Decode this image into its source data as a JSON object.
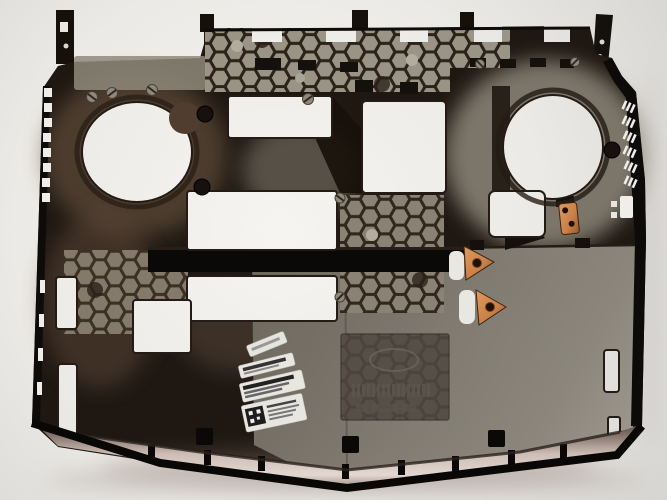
{
  "meta": {
    "type": "photograph",
    "subject": "laptop bottom base cover, inside view, photographed top-down on a light surface",
    "alt": "Dark bronze-black plastic laptop bottom chassis with two round fan openings, honeycomb vent grids, rectangular bay cutouts, copper clips and white service stickers"
  },
  "colors": {
    "background": "#e9e7e3",
    "chassis_dark": "#1d1610",
    "bronze_tint": "#6b5443",
    "plate_gray": "#7d7870",
    "honeycomb_cell": "#9a9487",
    "honeycomb_wall": "#2c221a",
    "copper": "#c97f45",
    "cutout_white": "#f2f0ec",
    "reflective_strip": "#cfc0b8",
    "sticker_white": "#e8e6e1"
  },
  "parts": {
    "chassis": {
      "name": "laptop-bottom-case"
    },
    "fan_openings": [
      {
        "name": "left-fan-opening"
      },
      {
        "name": "right-fan-opening"
      }
    ],
    "honeycomb_patches": [
      {
        "name": "top-vent-honeycomb"
      },
      {
        "name": "mid-left-honeycomb"
      },
      {
        "name": "mid-right-honeycomb"
      }
    ],
    "bay_openings": [
      {
        "name": "upper-left-bay-opening"
      },
      {
        "name": "upper-right-bay-opening"
      },
      {
        "name": "center-bay-opening"
      },
      {
        "name": "lower-center-bay-opening"
      },
      {
        "name": "lower-left-bay-opening"
      },
      {
        "name": "below-right-fan-opening"
      }
    ],
    "copper_clips": [
      {
        "name": "copper-clip-upper",
        "has_screw": true
      },
      {
        "name": "copper-clip-lower",
        "has_screw": true
      },
      {
        "name": "copper-bracket",
        "holes": 2
      }
    ],
    "stickers": [
      {
        "name": "small-service-sticker",
        "legible": false
      },
      {
        "name": "part-number-sticker",
        "legible": false
      },
      {
        "name": "serial-number-sticker",
        "legible": false
      },
      {
        "name": "qr-code-sticker",
        "legible": false,
        "has_qr_code": true
      }
    ],
    "vents": {
      "left_slot_count": 12,
      "right_slash_groups": 6
    },
    "emboss_plate": {
      "name": "regulatory-emboss-plate",
      "legible": false
    },
    "hinge_posts": 2
  }
}
